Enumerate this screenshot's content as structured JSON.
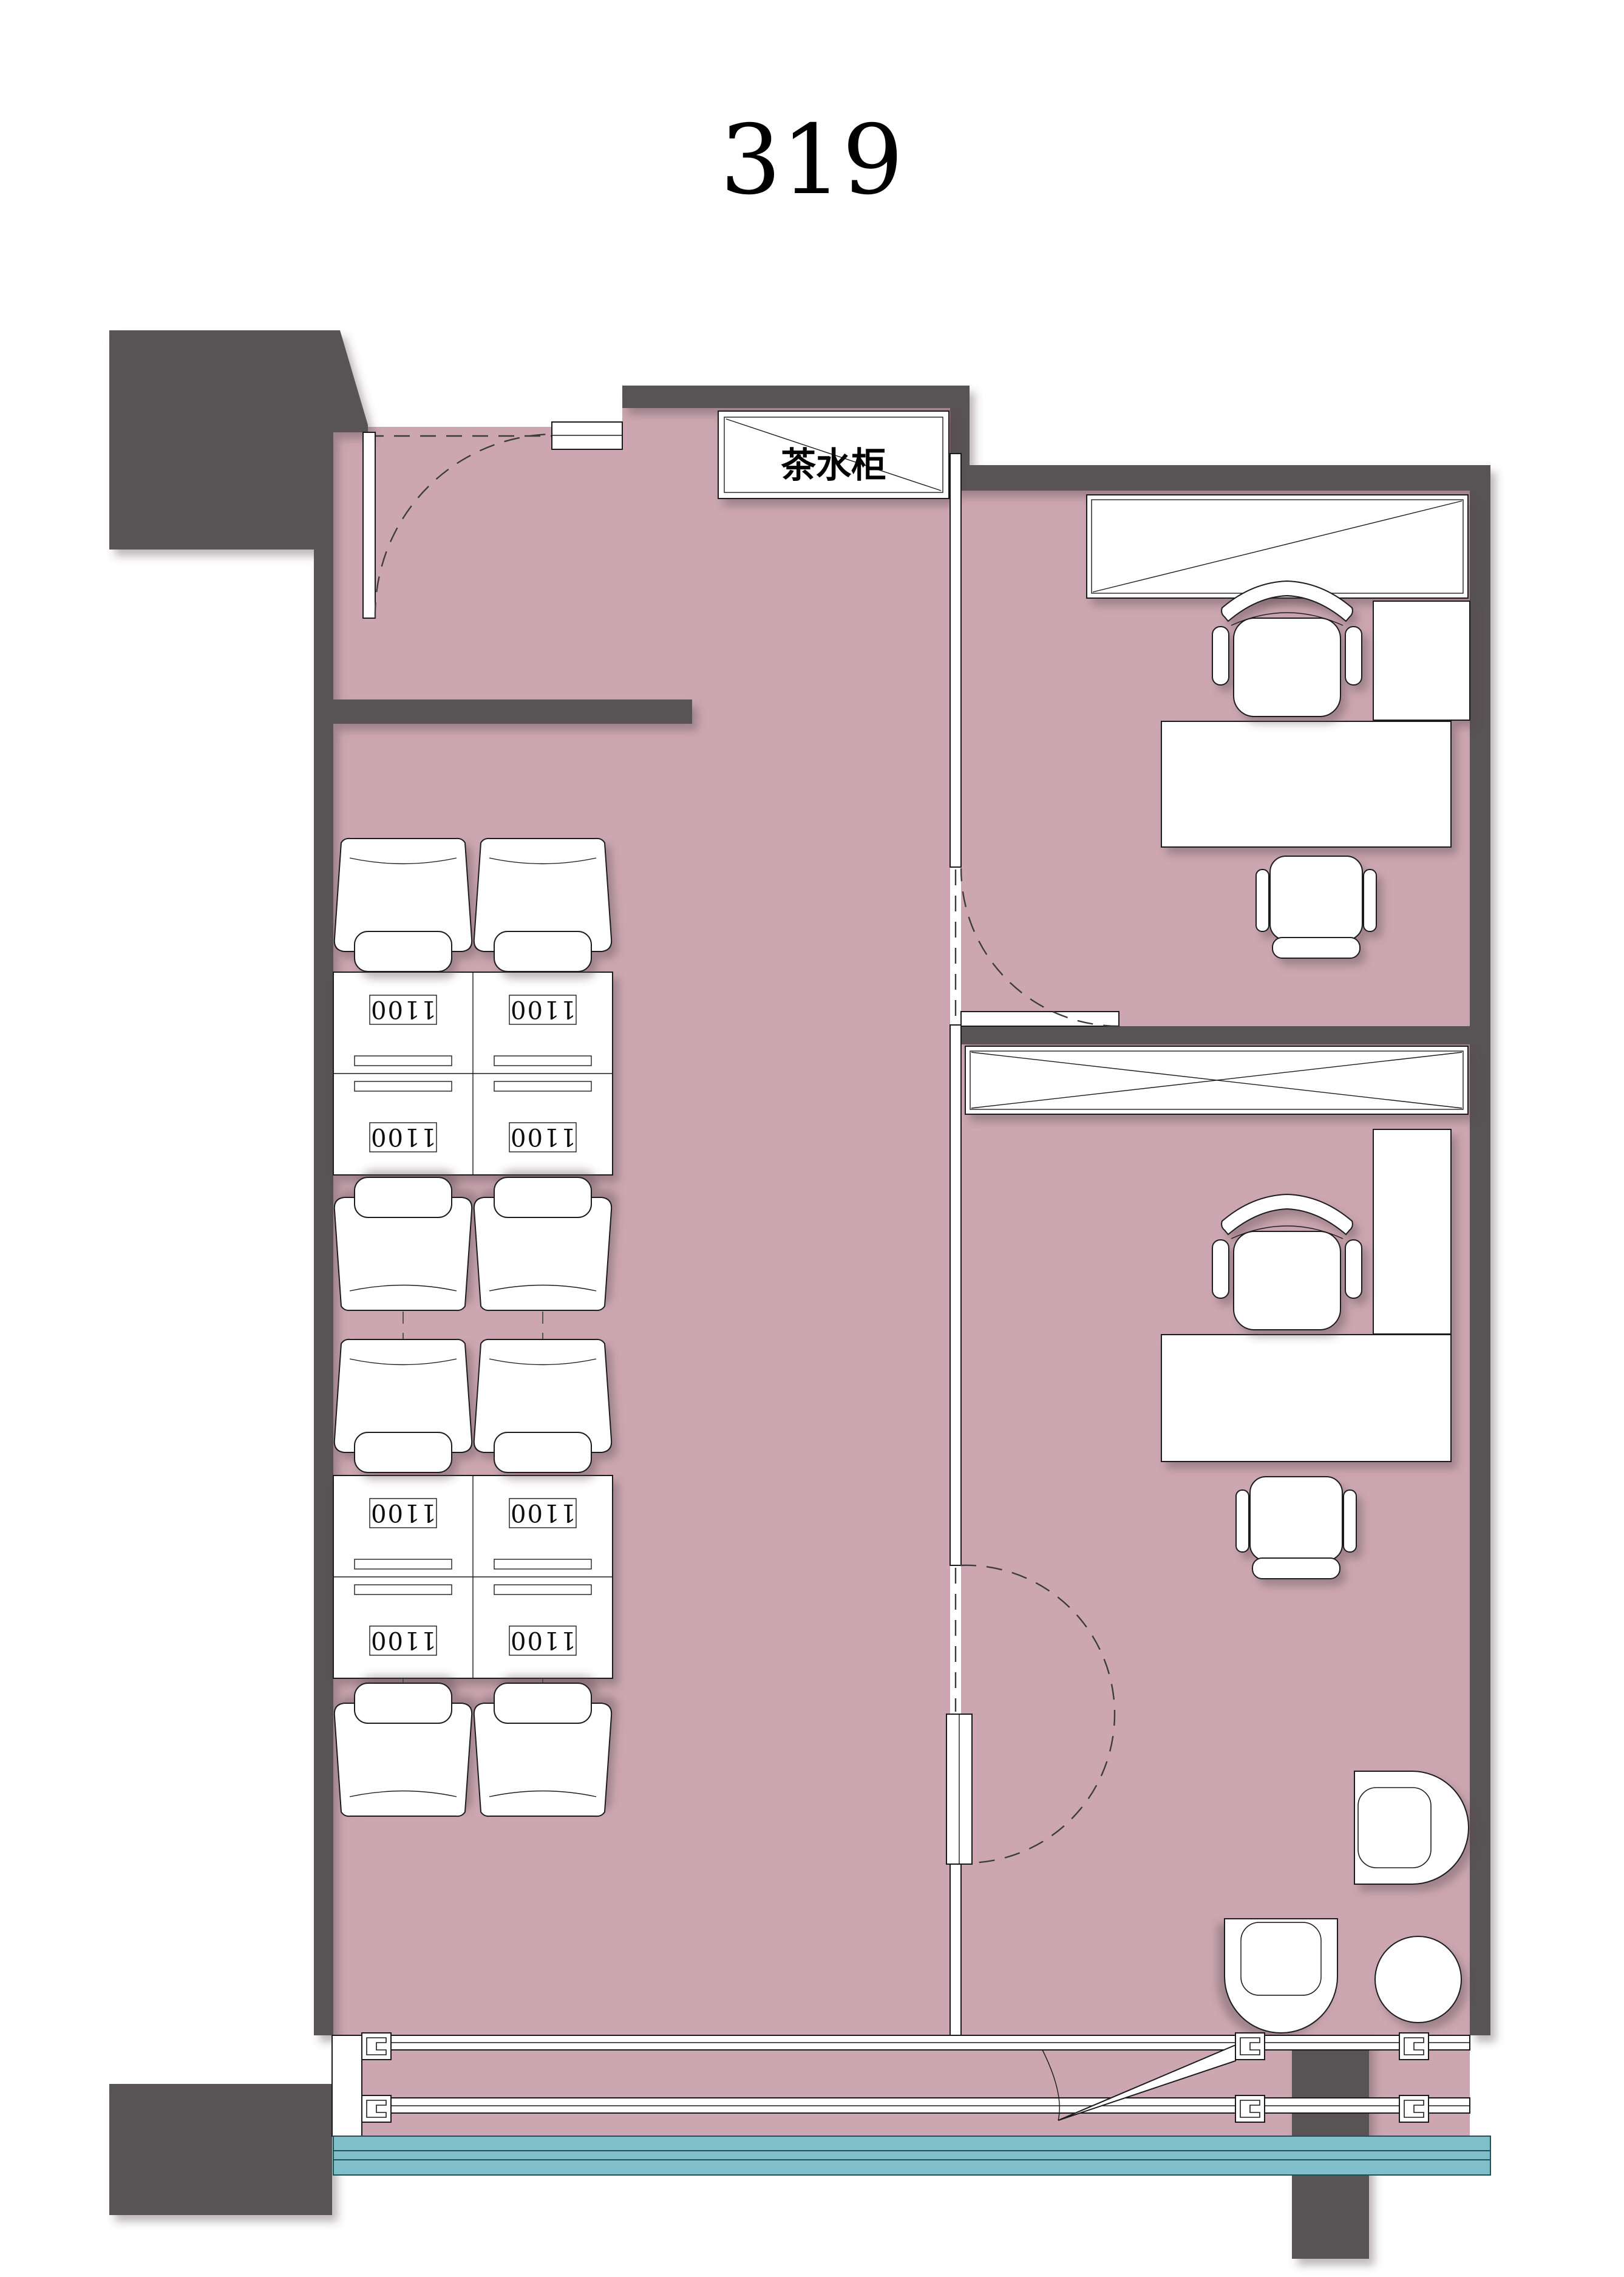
{
  "page": {
    "title": "319"
  },
  "plan": {
    "room_number": "319",
    "tea_cabinet": {
      "label": "茶水柜"
    },
    "workstations": [
      {
        "id": 1,
        "size_label": "1100"
      },
      {
        "id": 2,
        "size_label": "1100"
      },
      {
        "id": 3,
        "size_label": "1100"
      },
      {
        "id": 4,
        "size_label": "1100"
      },
      {
        "id": 5,
        "size_label": "1100"
      },
      {
        "id": 6,
        "size_label": "1100"
      },
      {
        "id": 7,
        "size_label": "1100"
      },
      {
        "id": 8,
        "size_label": "1100"
      }
    ],
    "colors": {
      "floor": "#cca7b2",
      "wall": "#585254",
      "glazing": "#7fbfca",
      "glazing_dark": "#23505b",
      "line": "#1a1a1a"
    }
  }
}
